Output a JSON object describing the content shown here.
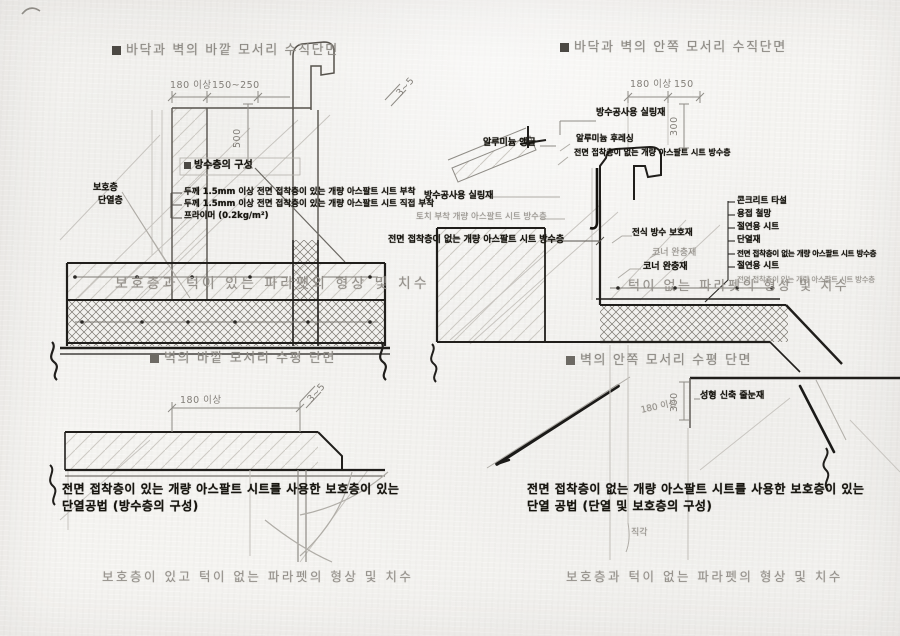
{
  "palette": {
    "paper": "#f4f3f0",
    "ink": "#201e1b",
    "gray_text": "#94908a",
    "mid_line": "#56524c",
    "light_line": "#c7c4be"
  },
  "left": {
    "section_title_top": "바닥과 벽의 바깥 모서리 수직단면",
    "dim_top_a": "180 이상",
    "dim_top_b": "150~250",
    "dim_slope_top": "3~5",
    "dim_height": "500",
    "wp_header": "방수층의 구성",
    "callout_1": "두께 1.5mm 이상 전면 접착층이 있는 개량 아스팔트 시트 부착",
    "callout_2": "두께 1.5mm 이상 전면 접착층이 있는 개량 아스팔트 시트 직접 부착",
    "callout_3": "프라이머 (0.2kg/m²)",
    "layer_label_1": "보호층",
    "layer_label_2": "단열층",
    "ghost_caption_mid": "보호층과 턱이 있는 파라펫의 형상 및 치수",
    "section_title_mid": "벽의 바깥 모서리 수평 단면",
    "dim_bottom_a": "180 이상",
    "dim_slope_bottom": "3~5",
    "note_line_1": "전면 접착층이 있는 개량 아스팔트 시트를 사용한 보호층이 있는",
    "note_line_2": "단열공법 (방수층의 구성)",
    "ghost_caption_bottom": "보호층이 있고 턱이 없는 파라펫의 형상 및 치수"
  },
  "right": {
    "section_title_top": "바닥과 벽의 안쪽 모서리 수직단면",
    "dim_top_a": "180 이상",
    "dim_top_b": "150",
    "dim_height_top": "300",
    "label_sealant_top": "방수공사용 실링재",
    "label_angle": "알루미늄 앵글",
    "label_flashing": "알루미늄 후레싱",
    "label_sheet_top": "전면 접착층이 없는 개량 아스팔트 시트 방수층",
    "label_sealant_mid": "방수공사용 실링재",
    "label_torch": "토치 부착 개량 아스팔트 시트 방수층",
    "label_sheet_mid": "전면 접착층이 없는 개량 아스팔트 시트 방수층",
    "label_protection": "전식 방수 보호재",
    "label_corner_ghost": "코너 완충재",
    "label_corner": "코너 완충재",
    "layers": [
      "콘크리트 타설",
      "용접 철망",
      "절연용 시트",
      "단열재",
      "전면 접착층이 없는 개량 아스팔트 시트 방수층",
      "절연용 시트"
    ],
    "layer_ghost": "전면 접착층이 있는 개량 아스팔트 시트 방수층",
    "ghost_caption_mid": "턱이 없는 파라펫의 형상 및 치수",
    "section_title_mid": "벽의 안쪽 모서리 수평 단면",
    "label_joint": "성형 신축 줄눈재",
    "dim_height_bottom": "300",
    "ghost_dim": "180 이상",
    "ghost_right_angle": "직각",
    "note_line_1": "전면 접착층이 없는 개량 아스팔트 시트를 사용한 보호층이 있는",
    "note_line_2": "단열 공법 (단열 및 보호층의 구성)",
    "ghost_caption_bottom": "보호층과 턱이 없는 파라펫의 형상 및 치수"
  }
}
